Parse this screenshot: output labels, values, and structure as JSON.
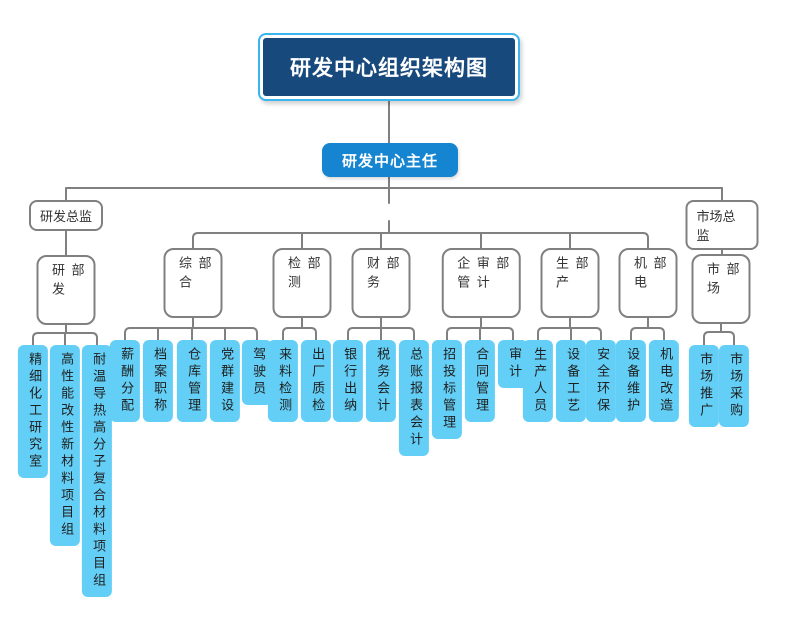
{
  "chart": {
    "root_title": "研发中心组织架构图",
    "head": "研发中心主任",
    "directors": [
      {
        "label": "研发总监"
      },
      {
        "label": "市场总监"
      }
    ],
    "departments": [
      {
        "label": "研发部",
        "children": [
          "精细化工研究室",
          "高性能改性新材料项目组",
          "耐温导热高分子复合材料项目组"
        ]
      },
      {
        "label": "综合部",
        "children": [
          "薪酬分配",
          "档案职称",
          "仓库管理",
          "党群建设",
          "驾驶员"
        ]
      },
      {
        "label": "检测部",
        "children": [
          "来料检测",
          "出厂质检"
        ]
      },
      {
        "label": "财务部",
        "children": [
          "银行出纳",
          "税务会计",
          "总账报表会计"
        ]
      },
      {
        "label": "企管审计部",
        "children": [
          "招投标管理",
          "合同管理",
          "审计"
        ]
      },
      {
        "label": "生产部",
        "children": [
          "生产人员",
          "设备工艺",
          "安全环保"
        ]
      },
      {
        "label": "机电部",
        "children": [
          "设备维护",
          "机电改造"
        ]
      },
      {
        "label": "市场部",
        "children": [
          "市场推广",
          "市场采购"
        ]
      }
    ],
    "colors": {
      "root_fill": "#18497D",
      "root_border": "#3CB4EE",
      "head_fill": "#1585D1",
      "leaf_fill": "#64CFF6",
      "line": "#808080"
    }
  }
}
